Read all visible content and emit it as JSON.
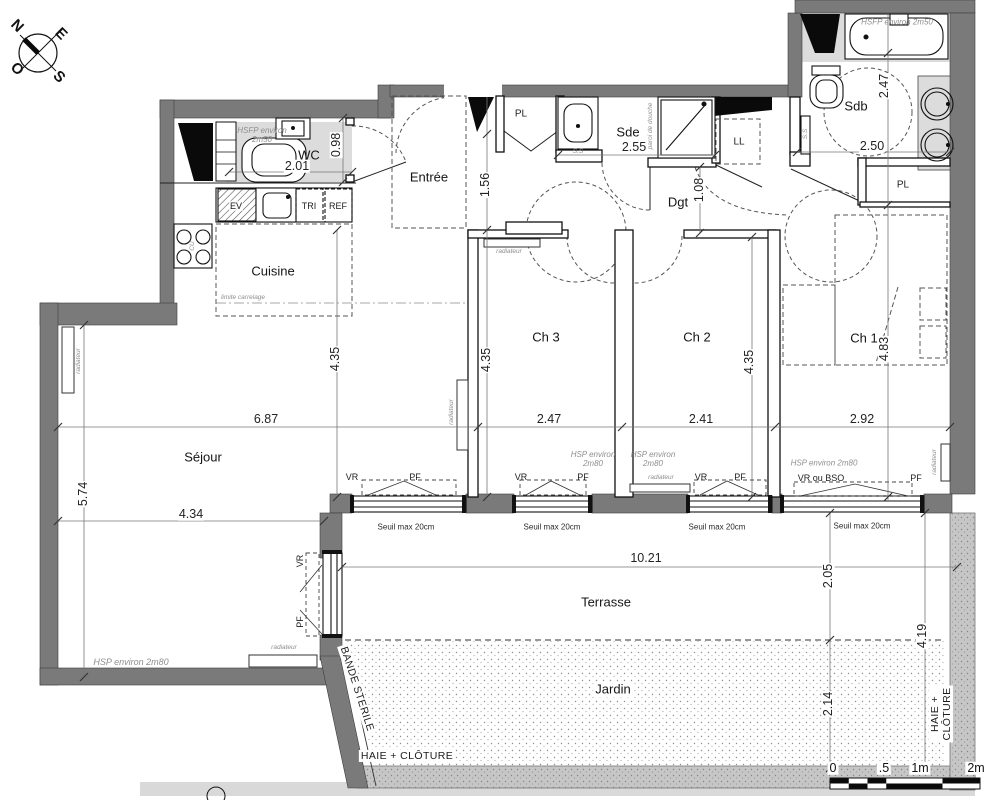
{
  "document_type": "apartment floor plan",
  "colors": {
    "exterior_wall": "#7a7a7a",
    "floor_shade": "#dcdcdc",
    "hedge": "#c6c6c6",
    "line": "#1c1c1c",
    "annotation_gray": "#8e8e8e"
  },
  "scale_bar": {
    "ticks": [
      "0",
      ".5",
      "1m",
      "2m"
    ]
  },
  "labels": {
    "compass": [
      {
        "name": "compass-n",
        "text": "N",
        "x": 17,
        "y": 26,
        "rot": 45,
        "cls": "compass"
      },
      {
        "name": "compass-e",
        "text": "E",
        "x": 61,
        "y": 34,
        "rot": 45,
        "cls": "compass"
      },
      {
        "name": "compass-s",
        "text": "S",
        "x": 59,
        "y": 77,
        "rot": 45,
        "cls": "compass"
      },
      {
        "name": "compass-o",
        "text": "O",
        "x": 17,
        "y": 69,
        "rot": 45,
        "cls": "compass"
      }
    ],
    "rooms": [
      {
        "name": "room-label-entree",
        "text": "Entrée",
        "x": 429,
        "y": 178,
        "cls": "room"
      },
      {
        "name": "room-label-wc",
        "text": "WC",
        "x": 309,
        "y": 156,
        "cls": "room"
      },
      {
        "name": "room-label-cuisine",
        "text": "Cuisine",
        "x": 273,
        "y": 272,
        "cls": "room"
      },
      {
        "name": "room-label-sejour",
        "text": "Séjour",
        "x": 203,
        "y": 458,
        "cls": "room"
      },
      {
        "name": "room-label-ch3",
        "text": "Ch 3",
        "x": 546,
        "y": 338,
        "cls": "room"
      },
      {
        "name": "room-label-ch2",
        "text": "Ch 2",
        "x": 697,
        "y": 338,
        "cls": "room"
      },
      {
        "name": "room-label-ch1",
        "text": "Ch 1",
        "x": 864,
        "y": 339,
        "cls": "room"
      },
      {
        "name": "room-label-sde",
        "text": "Sde",
        "x": 628,
        "y": 133,
        "cls": "room"
      },
      {
        "name": "room-label-sdb",
        "text": "Sdb",
        "x": 856,
        "y": 107,
        "cls": "room"
      },
      {
        "name": "room-label-dgt",
        "text": "Dgt",
        "x": 678,
        "y": 203,
        "cls": "room"
      },
      {
        "name": "room-label-pl-entree",
        "text": "PL",
        "x": 521,
        "y": 114,
        "cls": "room-sm"
      },
      {
        "name": "room-label-pl-ch1",
        "text": "PL",
        "x": 903,
        "y": 185,
        "cls": "room-sm"
      },
      {
        "name": "room-label-ll",
        "text": "LL",
        "x": 739,
        "y": 142,
        "cls": "room-sm"
      },
      {
        "name": "room-label-terrasse",
        "text": "Terrasse",
        "x": 606,
        "y": 603,
        "cls": "room"
      },
      {
        "name": "room-label-jardin",
        "text": "Jardin",
        "x": 613,
        "y": 690,
        "cls": "room chip"
      }
    ],
    "dimensions": [
      {
        "name": "dim-wc-width",
        "text": "2.01",
        "x": 297,
        "y": 166,
        "cls": "dim"
      },
      {
        "name": "dim-wc-depth",
        "text": "0.98",
        "x": 336,
        "y": 145,
        "rot": -90,
        "cls": "dim"
      },
      {
        "name": "dim-entree-width",
        "text": "1.56",
        "x": 485,
        "y": 185,
        "rot": -90,
        "cls": "dim"
      },
      {
        "name": "dim-sde-width",
        "text": "2.55",
        "x": 634,
        "y": 147,
        "cls": "dim"
      },
      {
        "name": "dim-dgt-width",
        "text": "1.08",
        "x": 699,
        "y": 190,
        "rot": -90,
        "cls": "dim"
      },
      {
        "name": "dim-sdb-depth",
        "text": "2.47",
        "x": 884,
        "y": 86,
        "rot": -90,
        "cls": "dim"
      },
      {
        "name": "dim-sdb-width",
        "text": "2.50",
        "x": 872,
        "y": 146,
        "cls": "dim"
      },
      {
        "name": "dim-cuisine-depth",
        "text": "4.35",
        "x": 335,
        "y": 359,
        "rot": -90,
        "cls": "dim"
      },
      {
        "name": "dim-sejour-width",
        "text": "6.87",
        "x": 266,
        "y": 419,
        "cls": "dim"
      },
      {
        "name": "dim-sejour-depth",
        "text": "5.74",
        "x": 83,
        "y": 494,
        "rot": -90,
        "cls": "dim"
      },
      {
        "name": "dim-sejour-width2",
        "text": "4.34",
        "x": 191,
        "y": 514,
        "cls": "dim"
      },
      {
        "name": "dim-ch3-depth",
        "text": "4.35",
        "x": 486,
        "y": 360,
        "rot": -90,
        "cls": "dim"
      },
      {
        "name": "dim-ch3-width",
        "text": "2.47",
        "x": 549,
        "y": 419,
        "cls": "dim"
      },
      {
        "name": "dim-ch2-depth",
        "text": "4.35",
        "x": 749,
        "y": 362,
        "rot": -90,
        "cls": "dim"
      },
      {
        "name": "dim-ch2-width",
        "text": "2.41",
        "x": 701,
        "y": 419,
        "cls": "dim"
      },
      {
        "name": "dim-ch1-depth",
        "text": "4.83",
        "x": 884,
        "y": 349,
        "rot": -90,
        "cls": "dim"
      },
      {
        "name": "dim-ch1-width",
        "text": "2.92",
        "x": 862,
        "y": 419,
        "cls": "dim"
      },
      {
        "name": "dim-terrasse-width",
        "text": "10.21",
        "x": 646,
        "y": 558,
        "cls": "dim"
      },
      {
        "name": "dim-terrasse-depth",
        "text": "2.05",
        "x": 828,
        "y": 576,
        "rot": -90,
        "cls": "dim"
      },
      {
        "name": "dim-jardin-depth",
        "text": "2.14",
        "x": 828,
        "y": 704,
        "rot": -90,
        "cls": "dim"
      },
      {
        "name": "dim-garden-total",
        "text": "4.19",
        "x": 922,
        "y": 636,
        "rot": -90,
        "cls": "dim"
      }
    ],
    "annotations": [
      {
        "name": "note-hsfp-wc",
        "text": "HSFP environ\n2m50",
        "x": 262,
        "y": 135,
        "cls": "ann"
      },
      {
        "name": "note-hsfp-bath",
        "text": "HSFP environ 2m50",
        "x": 897,
        "y": 22,
        "cls": "ann"
      },
      {
        "name": "note-hsp-sejour",
        "text": "HSP environ 2m80",
        "x": 131,
        "y": 662,
        "cls": "ann9"
      },
      {
        "name": "note-hsp-ch3",
        "text": "HSP environ\n2m80",
        "x": 593,
        "y": 459,
        "cls": "ann"
      },
      {
        "name": "note-hsp-ch2",
        "text": "HSP environ\n2m80",
        "x": 653,
        "y": 459,
        "cls": "ann"
      },
      {
        "name": "note-hsp-ch1",
        "text": "HSP environ 2m80",
        "x": 824,
        "y": 463,
        "cls": "ann"
      },
      {
        "name": "note-limite-carrelage",
        "text": "limite carrelage",
        "x": 243,
        "y": 298,
        "cls": "tiny"
      },
      {
        "name": "note-paroi-douche",
        "text": "paroi de douche",
        "x": 651,
        "y": 126,
        "rot": -90,
        "cls": "tiny"
      },
      {
        "name": "note-ss-sde",
        "text": "S.S",
        "x": 578,
        "y": 152,
        "cls": "tiny"
      },
      {
        "name": "note-ss-sdb",
        "text": "S.S",
        "x": 806,
        "y": 134,
        "rot": -90,
        "cls": "tiny"
      },
      {
        "name": "note-radiateur-sejour-left",
        "text": "radiateur",
        "x": 79,
        "y": 361,
        "rot": -90,
        "cls": "tiny"
      },
      {
        "name": "note-radiateur-sejour-bottom",
        "text": "radiateur",
        "x": 284,
        "y": 648,
        "cls": "tiny"
      },
      {
        "name": "note-radiateur-ch3-left",
        "text": "radiateur",
        "x": 452,
        "y": 412,
        "rot": -90,
        "cls": "tiny"
      },
      {
        "name": "note-radiateur-corridor",
        "text": "radiateur",
        "x": 509,
        "y": 252,
        "cls": "tiny"
      },
      {
        "name": "note-radiateur-ch2",
        "text": "radiateur",
        "x": 661,
        "y": 478,
        "cls": "tiny"
      },
      {
        "name": "note-radiateur-ch1",
        "text": "radiateur",
        "x": 935,
        "y": 462,
        "rot": -90,
        "cls": "tiny"
      },
      {
        "name": "note-cu-hob",
        "text": "CU",
        "x": 193,
        "y": 246,
        "rot": -90,
        "cls": "tiny"
      }
    ],
    "equipment": [
      {
        "name": "label-ev",
        "text": "EV",
        "x": 236,
        "y": 206,
        "cls": "eq"
      },
      {
        "name": "label-tri",
        "text": "TRI",
        "x": 309,
        "y": 206,
        "cls": "eq"
      },
      {
        "name": "label-ref",
        "text": "REF",
        "x": 338,
        "y": 206,
        "cls": "eq"
      }
    ],
    "windows": [
      {
        "name": "window-label-vr-west",
        "text": "VR",
        "x": 300,
        "y": 561,
        "rot": -90,
        "cls": "win"
      },
      {
        "name": "window-label-pf-west",
        "text": "PF",
        "x": 300,
        "y": 622,
        "rot": -90,
        "cls": "win"
      },
      {
        "name": "window-label-vr-1",
        "text": "VR",
        "x": 352,
        "y": 477,
        "cls": "win"
      },
      {
        "name": "window-label-pf-1",
        "text": "PF",
        "x": 415,
        "y": 477,
        "cls": "win"
      },
      {
        "name": "window-label-vr-2",
        "text": "VR",
        "x": 521,
        "y": 477,
        "cls": "win"
      },
      {
        "name": "window-label-pf-2",
        "text": "PF",
        "x": 583,
        "y": 477,
        "cls": "win"
      },
      {
        "name": "window-label-vr-3",
        "text": "VR",
        "x": 701,
        "y": 477,
        "cls": "win"
      },
      {
        "name": "window-label-pf-3",
        "text": "PF",
        "x": 740,
        "y": 477,
        "cls": "win"
      },
      {
        "name": "window-label-vrbso-4",
        "text": "VR ou BSO",
        "x": 821,
        "y": 478,
        "cls": "win"
      },
      {
        "name": "window-label-pf-4",
        "text": "PF",
        "x": 916,
        "y": 478,
        "cls": "win"
      },
      {
        "name": "seuil-label-1",
        "text": "Seuil max 20cm",
        "x": 406,
        "y": 527,
        "cls": "seuil"
      },
      {
        "name": "seuil-label-2",
        "text": "Seuil max 20cm",
        "x": 552,
        "y": 527,
        "cls": "seuil"
      },
      {
        "name": "seuil-label-3",
        "text": "Seuil max 20cm",
        "x": 717,
        "y": 527,
        "cls": "seuil"
      },
      {
        "name": "seuil-label-4",
        "text": "Seuil max 20cm",
        "x": 862,
        "y": 526,
        "cls": "seuil"
      }
    ],
    "site": [
      {
        "name": "label-bande-sterile",
        "text": "BANDE STERILE",
        "x": 357,
        "y": 689,
        "rot": 72,
        "cls": "caps"
      },
      {
        "name": "label-haie-cloture-bottom",
        "text": "HAIE + CLÔTURE",
        "x": 407,
        "y": 756,
        "cls": "caps"
      },
      {
        "name": "label-haie-cloture-right",
        "text": "HAIE + CLÔTURE",
        "x": 941,
        "y": 714,
        "rot": -90,
        "cls": "caps"
      }
    ],
    "scale": [
      {
        "name": "scale-tick-0",
        "text": "0",
        "x": 833,
        "y": 768,
        "cls": "scale"
      },
      {
        "name": "scale-tick-05",
        "text": ".5",
        "x": 884,
        "y": 768,
        "cls": "scale"
      },
      {
        "name": "scale-tick-1m",
        "text": "1m",
        "x": 920,
        "y": 768,
        "cls": "scale"
      },
      {
        "name": "scale-tick-2m",
        "text": "2m",
        "x": 976,
        "y": 768,
        "cls": "scale"
      }
    ]
  }
}
